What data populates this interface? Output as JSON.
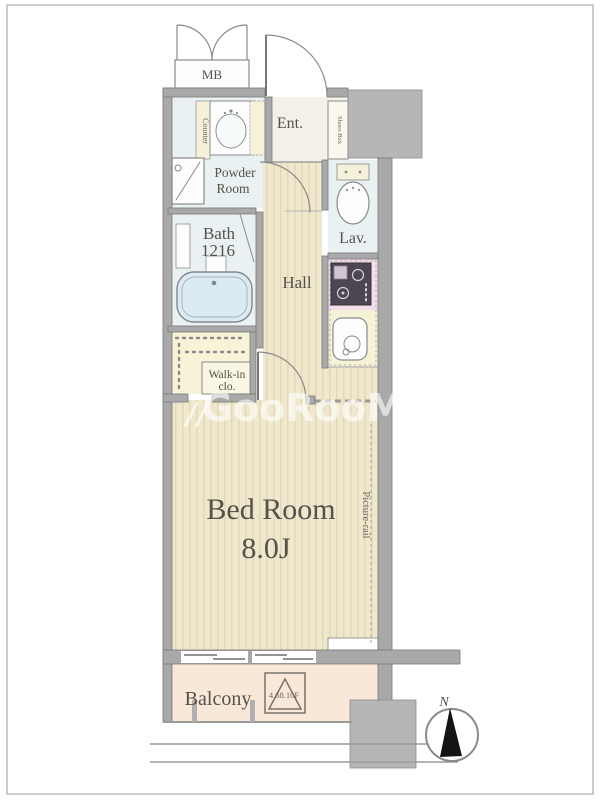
{
  "title": "apartment-floor-plan",
  "rooms": {
    "mb": {
      "label": "MB"
    },
    "entrance": {
      "label": "Ent."
    },
    "powder": {
      "line1": "Powder",
      "line2": "Room"
    },
    "bath": {
      "line1": "Bath",
      "line2": "1216"
    },
    "lavatory": {
      "label": "Lav."
    },
    "hall": {
      "label": "Hall"
    },
    "walkin_closet": {
      "line1": "Walk-in",
      "line2": "clo."
    },
    "bedroom": {
      "name": "Bed Room",
      "size": "8.0J"
    },
    "balcony": {
      "label": "Balcony",
      "note": "4.68.10F"
    }
  },
  "annotations": {
    "picture_rail": "Picture-rail",
    "counter": "Counter",
    "shoes_box": "Shoes Box",
    "compass_north": "N",
    "watermark_prefix": "//",
    "watermark": "GooRooM"
  },
  "colors": {
    "wall": "#a9a9a9",
    "wall_block": "#b6b6b6",
    "flooring": "#efe8cd",
    "flooring_stripe": "#e2d9b8",
    "wet_area": "#eaf1f2",
    "entrance_tile": "#f2f0e7",
    "kitchen_stove_area": "#f2dfe9",
    "kitchen_counter": "#f6f2d8",
    "closet": "#f7f3d6",
    "balcony": "#f9e7d8",
    "bathtub": "#dceaf2",
    "text": "#54524a"
  }
}
